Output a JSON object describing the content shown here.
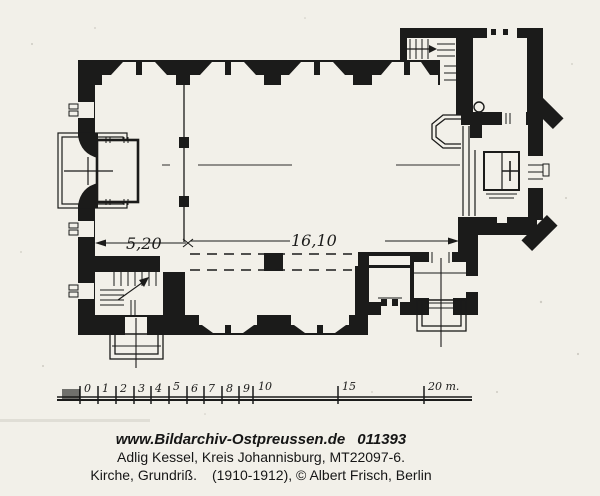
{
  "page": {
    "paper_color": "#f2f0e9",
    "ink_color": "#1b1b1a"
  },
  "plan": {
    "dimension_west": "5,20",
    "dimension_nave": "16,10"
  },
  "scalebar": {
    "labels": [
      "0",
      "1",
      "2",
      "3",
      "4",
      "5",
      "6",
      "7",
      "8",
      "9",
      "10",
      "15",
      "20 m."
    ]
  },
  "caption": {
    "url": "www.Bildarchiv-Ostpreussen.de",
    "archive_number": "011393",
    "location": "Adlig Kessel, Kreis Johannisburg, MT22097-6.",
    "subject": "Kirche, Grundriß.",
    "credit": "(1910-1912), © Albert Frisch, Berlin"
  }
}
